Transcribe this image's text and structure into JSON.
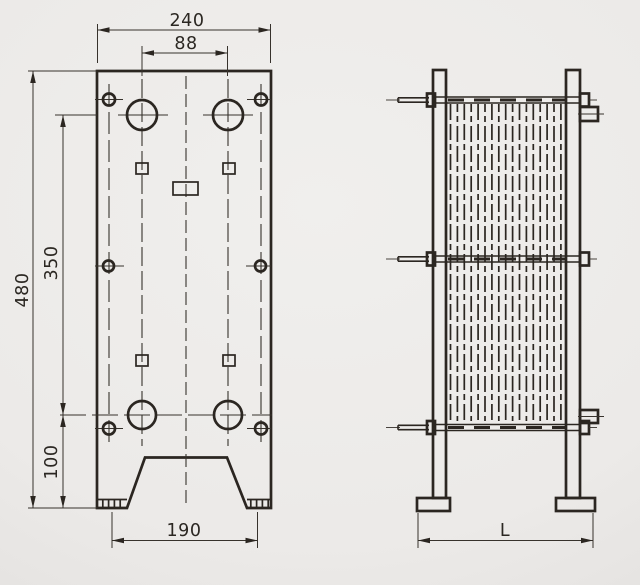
{
  "drawing": {
    "type": "technical-dimension-diagram",
    "subject": "plate-heat-exchanger",
    "front_view": {
      "label_overall_width": "240",
      "label_port_span": "88",
      "label_overall_height": "480",
      "label_port_vertical_span": "350",
      "label_port_to_base": "100",
      "label_feet_span": "190"
    },
    "side_view": {
      "label_frame_length": "L"
    },
    "colors": {
      "line": "#2b2621",
      "background_light": "#f0efed",
      "background_dark": "#dedcda"
    }
  }
}
